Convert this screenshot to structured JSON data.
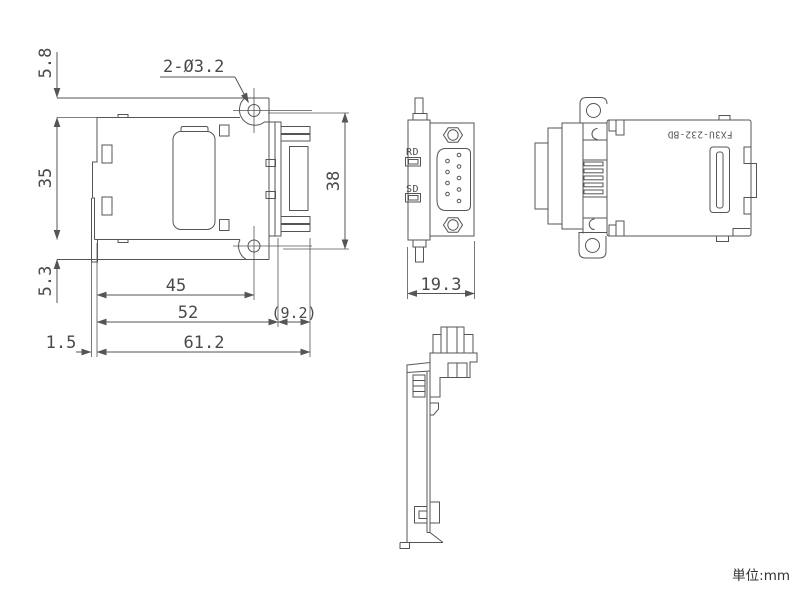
{
  "drawing": {
    "units_note": "単位:mm",
    "product_label": "FX3U-232-BD",
    "front_view": {
      "dims": {
        "hole_note": "2-Ø3.2",
        "flange_top_offset": "5.8",
        "body_height": "35",
        "flange_bottom_offset": "5.3",
        "hole_pitch": "45",
        "body_width": "52",
        "connector_protrusion": "(9.2)",
        "overall_width": "61.2",
        "hook_offset": "1.5",
        "connector_height": "38"
      }
    },
    "side_view": {
      "led_labels": {
        "rd": "RD",
        "sd": "SD"
      },
      "dims": {
        "overall_depth": "19.3"
      }
    }
  },
  "colors": {
    "line": "#555555",
    "text": "#4a4a4a",
    "background": "#ffffff"
  }
}
